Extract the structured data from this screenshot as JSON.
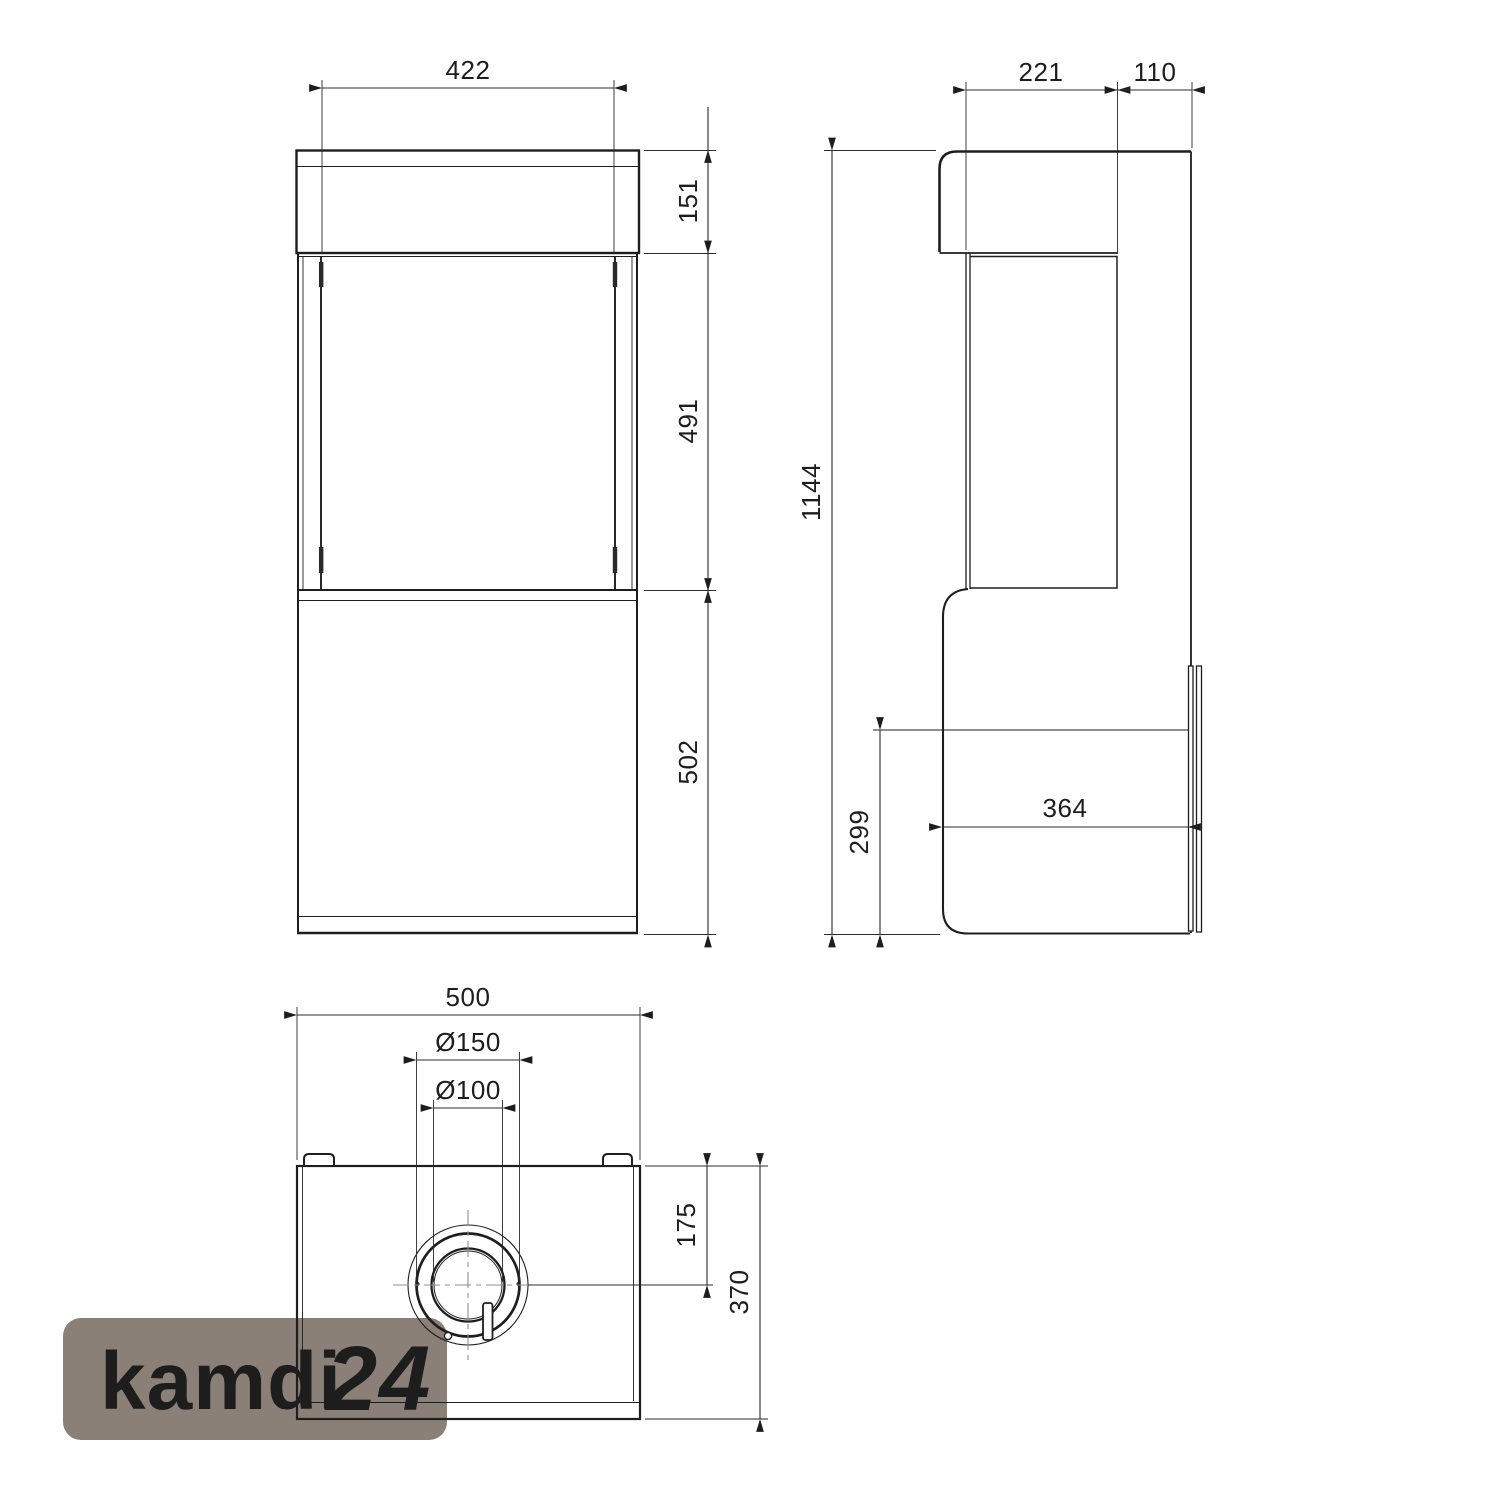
{
  "page": {
    "background": "#ffffff",
    "ink": "#1e1e1e",
    "dim_line_color": "#2b2b2b",
    "centerline_color": "#8f8f8f"
  },
  "views": {
    "front": {
      "title": "front-view",
      "dimensions": {
        "top_width": "422",
        "cap_height": "151",
        "glass_height": "491",
        "base_height": "502"
      }
    },
    "side": {
      "title": "side-view",
      "dimensions": {
        "top_depth": "221",
        "rear_offset": "110",
        "total_height": "1144",
        "base_height": "299",
        "base_depth": "364"
      }
    },
    "top": {
      "title": "top-view",
      "dimensions": {
        "width": "500",
        "flue_outer_dia": "Ø150",
        "flue_inner_dia": "Ø100",
        "flue_center_offset": "175",
        "depth": "370"
      }
    }
  },
  "watermark": {
    "brand": "kamdi",
    "suffix": "24",
    "bg_color": "#8B8077",
    "brand_color": "#85C6EA",
    "suffix_color": "#F1A64E"
  }
}
